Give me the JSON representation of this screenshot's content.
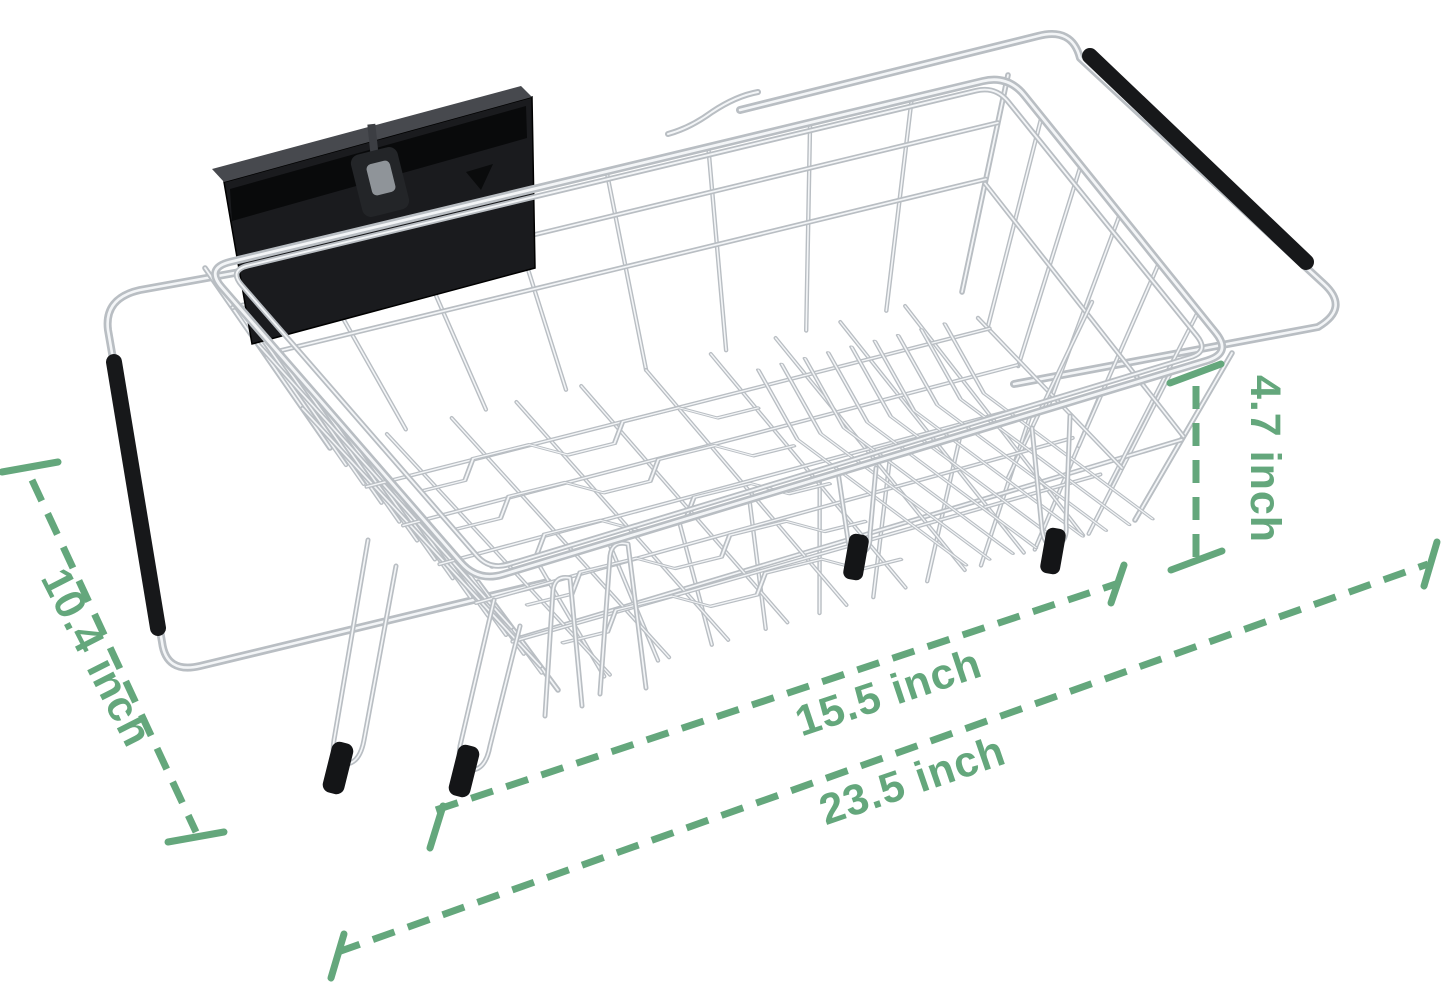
{
  "annotations": {
    "depth_label": "10.4 inch",
    "inner_length_label": "15.5 inch",
    "overall_length_label": "23.5 inch",
    "height_label": "4.7 inch"
  },
  "colors": {
    "background": "#ffffff",
    "dimension_green": "#64a77c",
    "chrome": "#b9bec3",
    "chrome_highlight": "#f3f5f7",
    "black_parts": "#17181a"
  },
  "icons": {
    "dish_rack_illustration": "wire-basket-icon",
    "utensil_holder": "black-caddy-icon",
    "sink_grips": "rubber-grip-icon"
  }
}
